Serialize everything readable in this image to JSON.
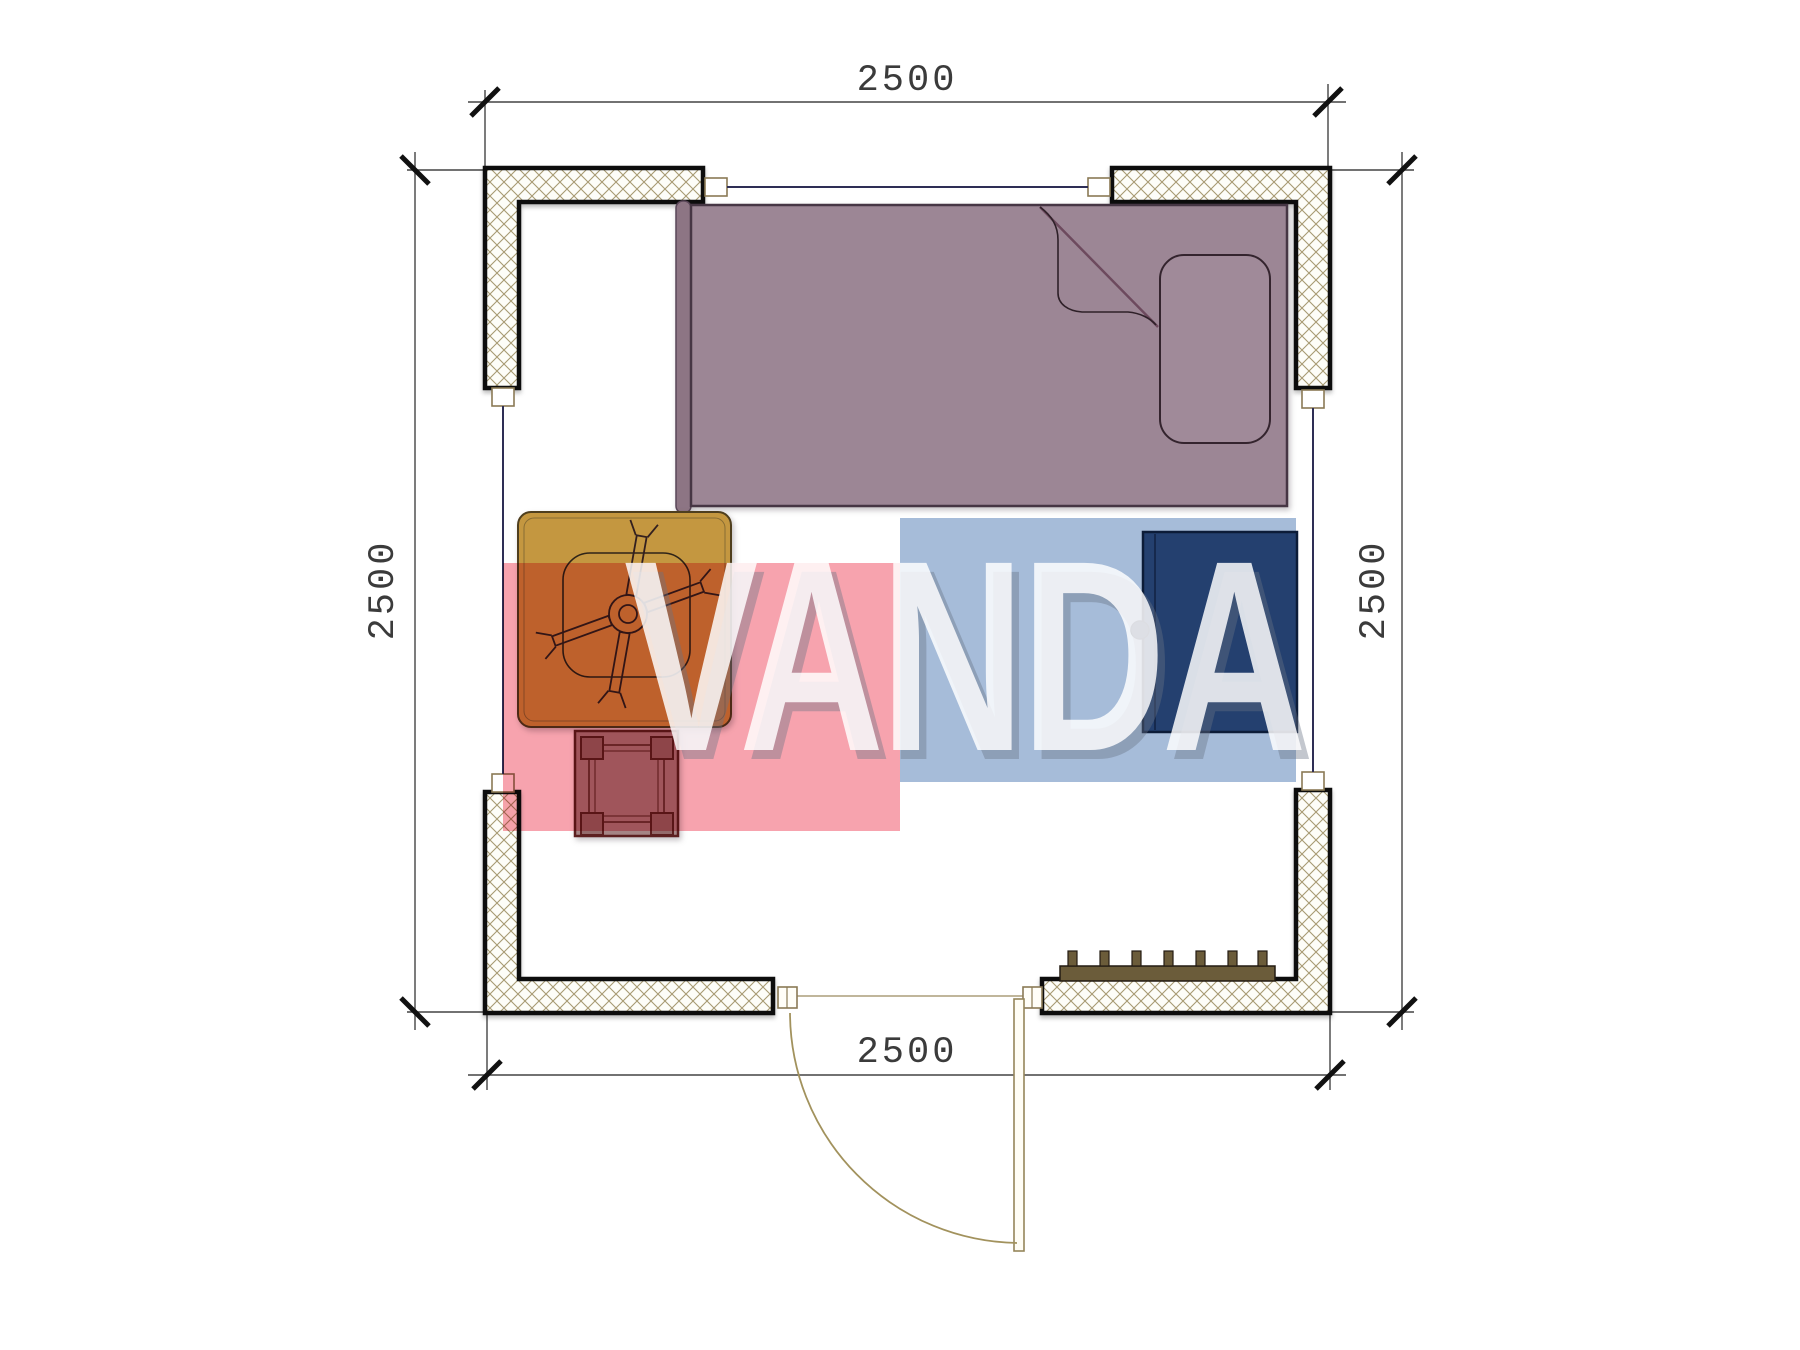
{
  "watermark": {
    "text": "VANDA",
    "pink_color": "#f7a3ae",
    "blue_color": "#a6bcd9"
  },
  "dimensions": {
    "top": "2500",
    "bottom": "2500",
    "left": "2500",
    "right": "2500"
  },
  "objects": {
    "bed": "single-bed",
    "headboard": "headboard",
    "pillow": "pillow",
    "blanket": "blanket-fold",
    "table": "square-table",
    "fan": "table-fan",
    "stool": "stool",
    "wardrobe": "wardrobe",
    "radiator": "radiator",
    "door": "swing-door",
    "window_top": "window",
    "window_left": "window",
    "window_right": "window"
  },
  "colors": {
    "bed": "#9c8695",
    "table": "#c49740",
    "wardrobe": "#24406f",
    "stool": "#a58585",
    "radiator": "#6b5c3a",
    "wall_hatch": "#a79a72",
    "dimension_line": "#3b3b3b"
  }
}
